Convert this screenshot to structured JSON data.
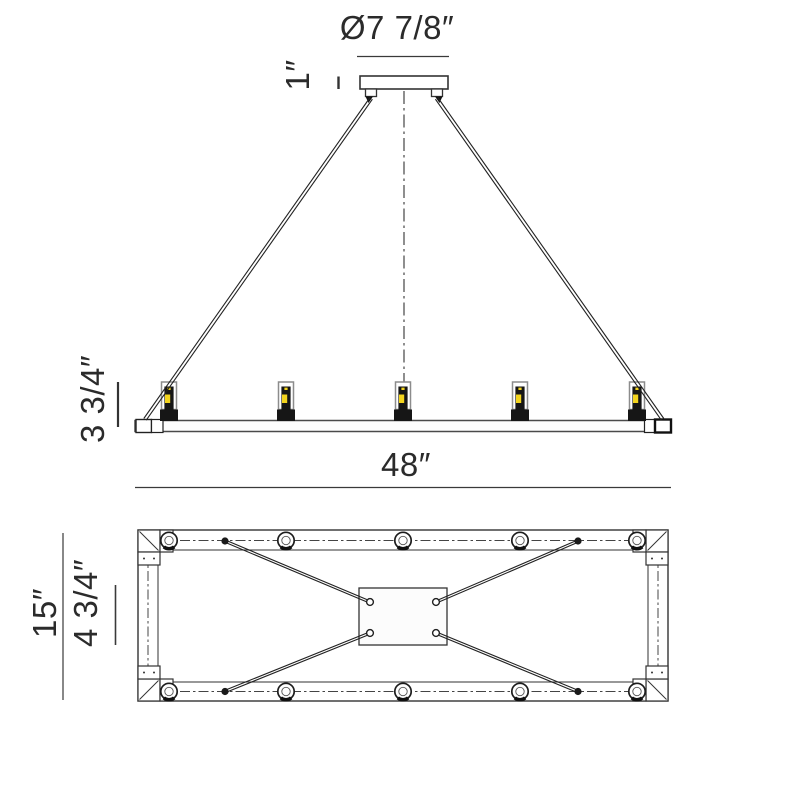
{
  "drawing": {
    "type": "technical-dimension-drawing",
    "subject": "linear-chandelier",
    "background_color": "#ffffff",
    "line_color": "#2b2b2b",
    "accent_color": "#f3d41e",
    "views": {
      "elevation": {
        "lamp_count": 5
      },
      "plan": {
        "grommet_count": 10,
        "cable_count": 4
      }
    },
    "labels": {
      "canopy_diameter": "Ø7 7/8″",
      "canopy_height": "1″",
      "fixture_height": "3 3/4″",
      "fixture_width": "48″",
      "frame_depth": "15″",
      "plate_depth": "4 3/4″"
    }
  }
}
